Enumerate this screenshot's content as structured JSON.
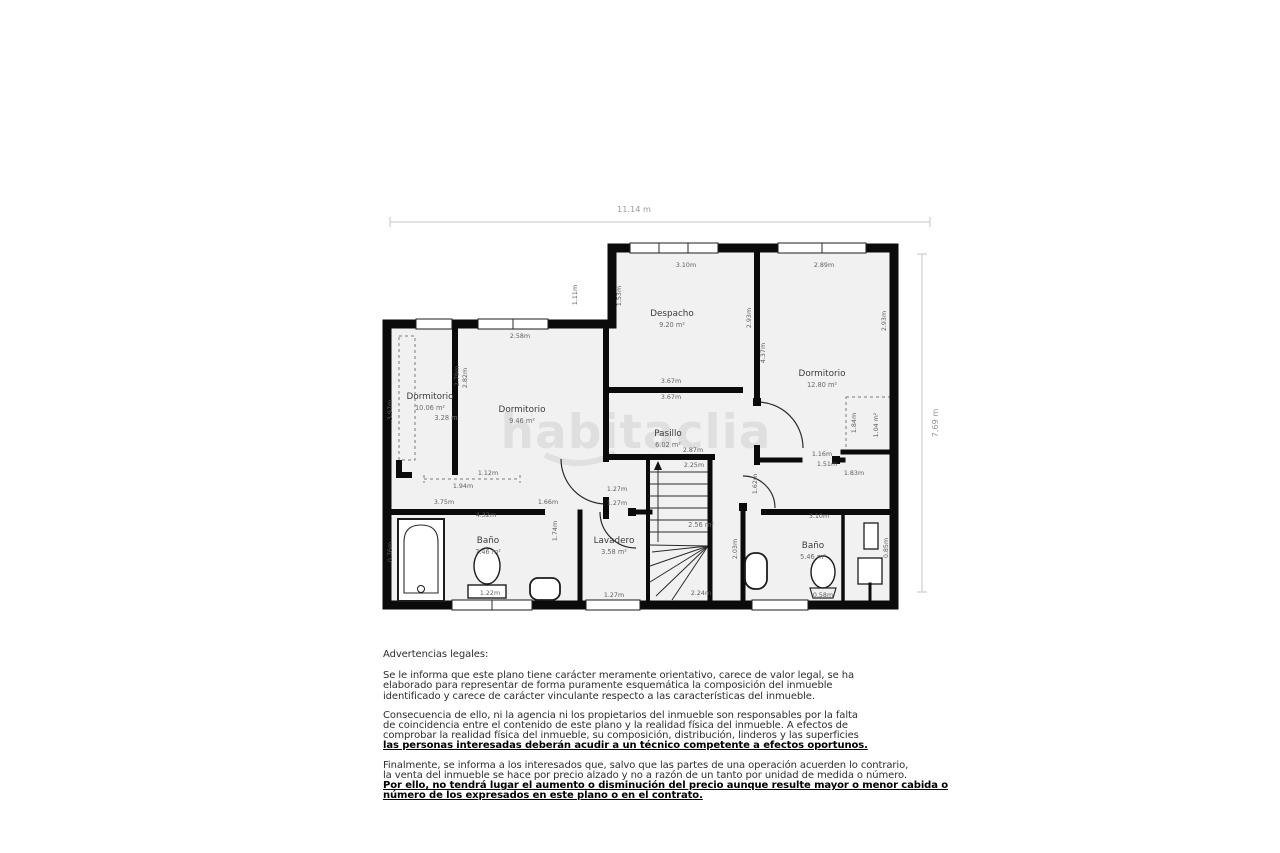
{
  "watermark": "habitaclia",
  "plan": {
    "dim_top": "11.14 m",
    "dim_right": "7.69 m",
    "rooms": [
      {
        "name": "Dormitorio",
        "area": "10.06 m²",
        "extra": "3.28 m",
        "x": 430,
        "y": 399
      },
      {
        "name": "Dormitorio",
        "area": "9.46 m²",
        "x": 522,
        "y": 412
      },
      {
        "name": "Despacho",
        "area": "9.20 m²",
        "x": 672,
        "y": 316
      },
      {
        "name": "Dormitorio",
        "area": "12.80 m²",
        "x": 822,
        "y": 376
      },
      {
        "name": "Pasillo",
        "area": "6.02 m²",
        "x": 668,
        "y": 436
      },
      {
        "name": "Baño",
        "area": "7.46 m²",
        "x": 488,
        "y": 543
      },
      {
        "name": "Lavadero",
        "area": "3.58 m²",
        "x": 614,
        "y": 543
      },
      {
        "name": "Baño",
        "area": "5.46 m²",
        "x": 813,
        "y": 548
      },
      {
        "name": "",
        "area": "2.56 m²",
        "x": 701,
        "y": 527
      }
    ],
    "dimension_labels": [
      {
        "t": "2.58m",
        "x": 520,
        "y": 338
      },
      {
        "t": "3.10m",
        "x": 686,
        "y": 267
      },
      {
        "t": "2.89m",
        "x": 824,
        "y": 267
      },
      {
        "t": "3.67m",
        "x": 671,
        "y": 383
      },
      {
        "t": "3.67m",
        "x": 671,
        "y": 399
      },
      {
        "t": "2.87m",
        "x": 693,
        "y": 452
      },
      {
        "t": "2.25m",
        "x": 694,
        "y": 467
      },
      {
        "t": "1.27m",
        "x": 617,
        "y": 491
      },
      {
        "t": "1.27m",
        "x": 617,
        "y": 505
      },
      {
        "t": "1.27m",
        "x": 614,
        "y": 597
      },
      {
        "t": "3.75m",
        "x": 444,
        "y": 504
      },
      {
        "t": "1.66m",
        "x": 548,
        "y": 504
      },
      {
        "t": "4.32m",
        "x": 486,
        "y": 517
      },
      {
        "t": "1.12m",
        "x": 488,
        "y": 475
      },
      {
        "t": "1.94m",
        "x": 463,
        "y": 488
      },
      {
        "t": "1.22m",
        "x": 490,
        "y": 595
      },
      {
        "t": "2.24m",
        "x": 701,
        "y": 595
      },
      {
        "t": "0.58m",
        "x": 823,
        "y": 597
      },
      {
        "t": "3.10m",
        "x": 819,
        "y": 518
      },
      {
        "t": "1.16m",
        "x": 822,
        "y": 456
      },
      {
        "t": "1.51m",
        "x": 827,
        "y": 466
      },
      {
        "t": "1.83m",
        "x": 854,
        "y": 475
      },
      {
        "t": "1.53m",
        "x": 621,
        "y": 296,
        "rot": -90
      },
      {
        "t": "1.11m",
        "x": 577,
        "y": 295,
        "rot": -90
      },
      {
        "t": "2.93m",
        "x": 751,
        "y": 318,
        "rot": -90
      },
      {
        "t": "4.37m",
        "x": 765,
        "y": 353,
        "rot": -90
      },
      {
        "t": "2.93m",
        "x": 886,
        "y": 321,
        "rot": -90
      },
      {
        "t": "2.79m",
        "x": 459,
        "y": 376,
        "rot": -90
      },
      {
        "t": "2.82m",
        "x": 467,
        "y": 378,
        "rot": -90
      },
      {
        "t": "3.97m",
        "x": 392,
        "y": 410,
        "rot": -90
      },
      {
        "t": "1.62m",
        "x": 757,
        "y": 484,
        "rot": -90
      },
      {
        "t": "1.74m",
        "x": 557,
        "y": 531,
        "rot": -90
      },
      {
        "t": "2.03m",
        "x": 737,
        "y": 549,
        "rot": -90
      },
      {
        "t": "0.76m",
        "x": 392,
        "y": 552,
        "rot": -90
      },
      {
        "t": "0.85m",
        "x": 888,
        "y": 548,
        "rot": -90
      },
      {
        "t": "1.84m",
        "x": 856,
        "y": 423,
        "rot": -90
      },
      {
        "t": "1.04 m²",
        "x": 878,
        "y": 425,
        "rot": -90
      }
    ]
  },
  "legal": {
    "heading": "Advertencias legales:",
    "paragraphs": [
      {
        "lines": [
          {
            "text": "Se le informa que este plano tiene carácter meramente orientativo, carece de valor legal, se ha",
            "emph": false
          },
          {
            "text": "elaborado para representar de forma puramente esquemática la composición del inmueble",
            "emph": false
          },
          {
            "text": "identificado y carece de carácter vinculante respecto a las características del inmueble.",
            "emph": false
          }
        ]
      },
      {
        "lines": [
          {
            "text": "Consecuencia de ello, ni la agencia ni los propietarios del inmueble son responsables por la falta",
            "emph": false
          },
          {
            "text": "de coincidencia entre el contenido de este plano y la realidad física del inmueble. A efectos de",
            "emph": false
          },
          {
            "text": "comprobar la realidad física del inmueble, su composición, distribución, linderos y las superficies",
            "emph": false
          },
          {
            "text": "las personas interesadas deberán acudir a un técnico competente a efectos oportunos.",
            "emph": true
          }
        ]
      },
      {
        "lines": [
          {
            "text": "Finalmente, se informa a los interesados que, salvo que las partes de una operación acuerden lo contrario,",
            "emph": false
          },
          {
            "text": "la venta del inmueble se hace por precio alzado y no a razón de un tanto por unidad de medida o número.",
            "emph": false
          },
          {
            "text": "Por ello, no tendrá lugar el aumento o disminución del precio aunque resulte mayor o menor cabida o",
            "emph": true
          },
          {
            "text": "número de los expresados en este plano o en el contrato.",
            "emph": true
          }
        ]
      }
    ]
  }
}
